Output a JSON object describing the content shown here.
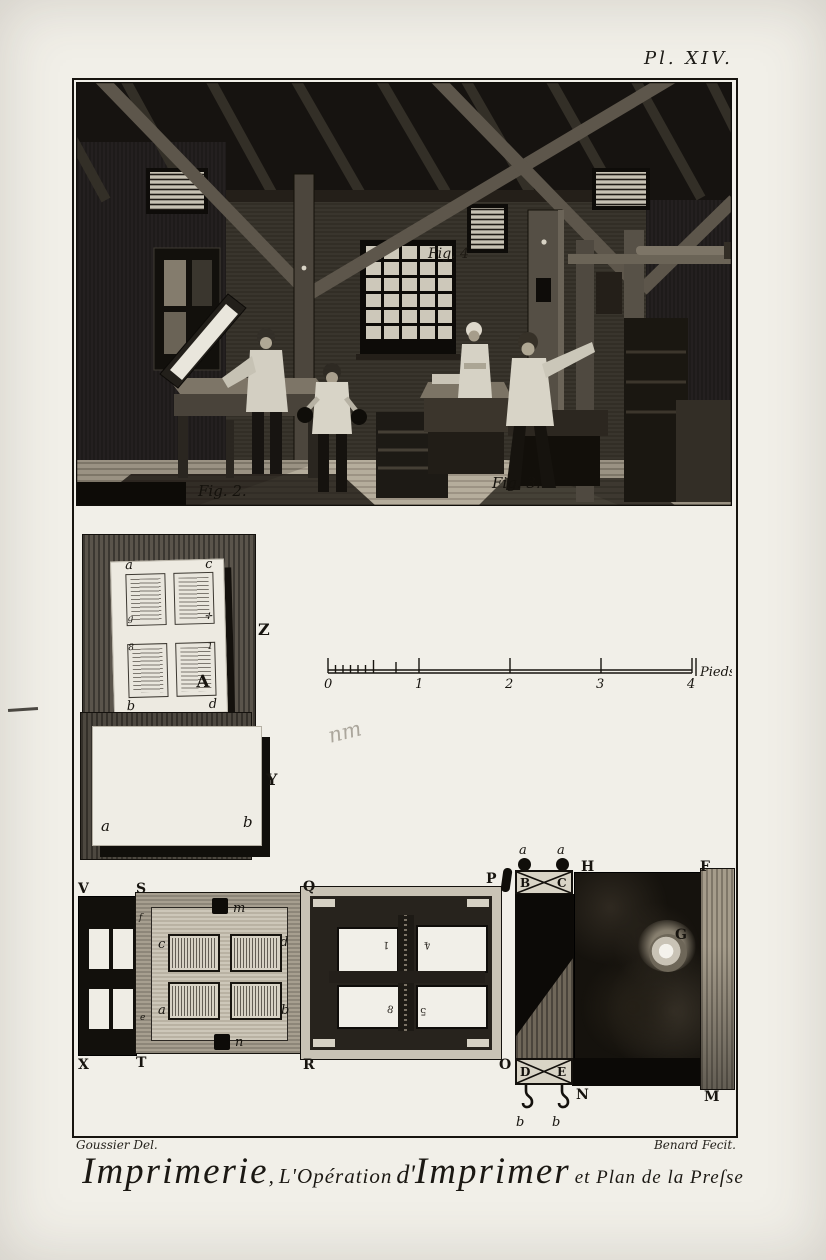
{
  "plate": {
    "label": "Pl. XIV."
  },
  "scene": {
    "fig2_label": "Fig. 2.",
    "fig3_label": "Fig. 3.",
    "fig4_label": "Fig. 4"
  },
  "forme_z": {
    "label": "Z",
    "corner_top_left": "a",
    "corner_top_right": "c",
    "corner_bottom_left": "b",
    "corner_bottom_right": "d",
    "mark_page1": "g",
    "mark_page2": "✛",
    "mark_page3": "8",
    "mark_page4": "1",
    "big_letter": "A"
  },
  "sheet_y": {
    "label": "Y",
    "corner_left": "a",
    "corner_right": "b"
  },
  "scale_bar": {
    "ticks": [
      "0",
      "1",
      "2",
      "3",
      "4"
    ],
    "unit": "Pieds.",
    "pencil_note": "nm"
  },
  "plan": {
    "corner_labels": {
      "v": "V",
      "s": "S",
      "q": "Q",
      "p": "P",
      "h": "H",
      "f": "F",
      "x": "X",
      "t": "T",
      "r": "R",
      "o": "O",
      "n": "N",
      "m": "M"
    },
    "box_letters": {
      "b": "B",
      "c": "C",
      "d": "D",
      "e": "E"
    },
    "screw_label": "G",
    "clamp_top": "m",
    "clamp_bottom": "n",
    "rail_top": "f",
    "rail_bottom": "e",
    "pages": {
      "top_left": "c",
      "top_right": "d",
      "bottom_left": "a",
      "bottom_right": "b"
    },
    "knobs": {
      "left": "a",
      "right": "a"
    },
    "hooks": {
      "left": "b",
      "right": "b"
    },
    "window_numbers": {
      "top_left": "1",
      "top_right": "4",
      "bottom_left": "8",
      "bottom_right": "5"
    }
  },
  "credits": {
    "left": "Goussier Del.",
    "right": "Benard Fecit."
  },
  "title": {
    "word1": "Imprimerie",
    "comma": ",",
    "word2": "L'Opération",
    "word3": "d'",
    "word4": "Imprimer",
    "word5": "et Plan de la Preſse"
  }
}
